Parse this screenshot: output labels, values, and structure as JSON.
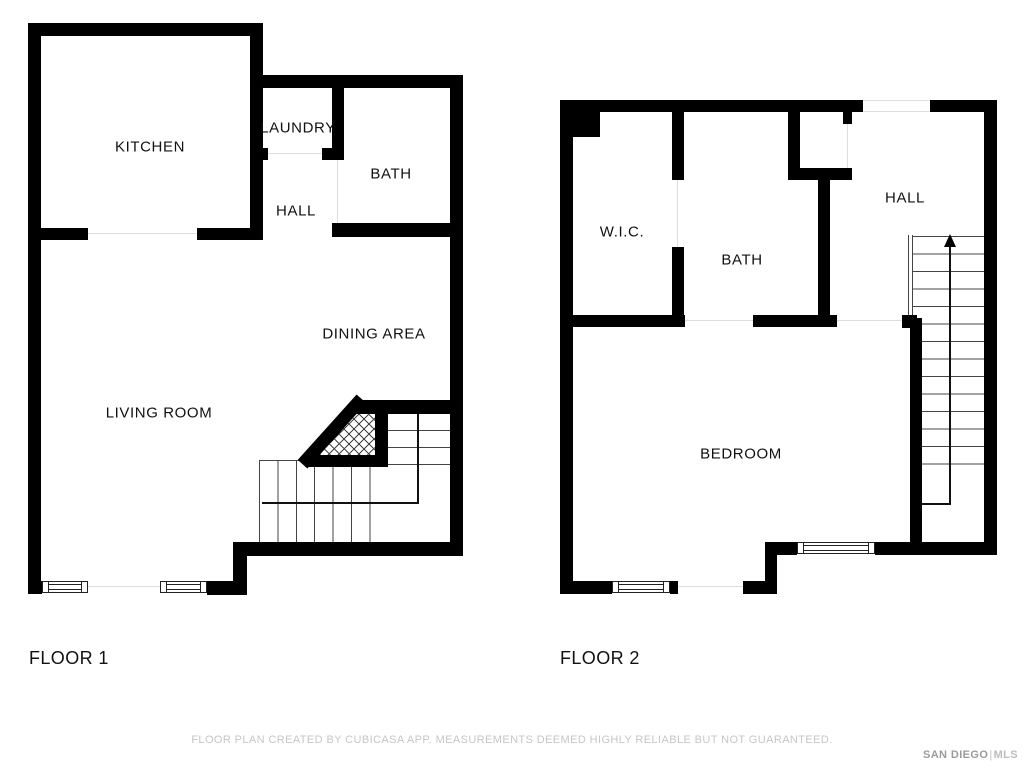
{
  "floor1": {
    "label": "FLOOR 1",
    "rooms": {
      "kitchen": "KITCHEN",
      "laundry": "LAUNDRY",
      "hall": "HALL",
      "bath": "BATH",
      "dining": "DINING AREA",
      "living": "LIVING ROOM"
    }
  },
  "floor2": {
    "label": "FLOOR 2",
    "rooms": {
      "wic": "W.I.C.",
      "bath": "BATH",
      "hall": "HALL",
      "bedroom": "BEDROOM"
    }
  },
  "footer": {
    "disclaimer": "FLOOR PLAN CREATED BY CUBICASA APP. MEASUREMENTS DEEMED HIGHLY RELIABLE BUT NOT GUARANTEED.",
    "brand_primary": "SAN DIEGO",
    "brand_divider": "|",
    "brand_secondary": "MLS"
  },
  "colors": {
    "wall": "#000000",
    "label_text": "#111111",
    "disclaimer_text": "#c6c6c6",
    "brand_text": "#9b9b9b"
  }
}
